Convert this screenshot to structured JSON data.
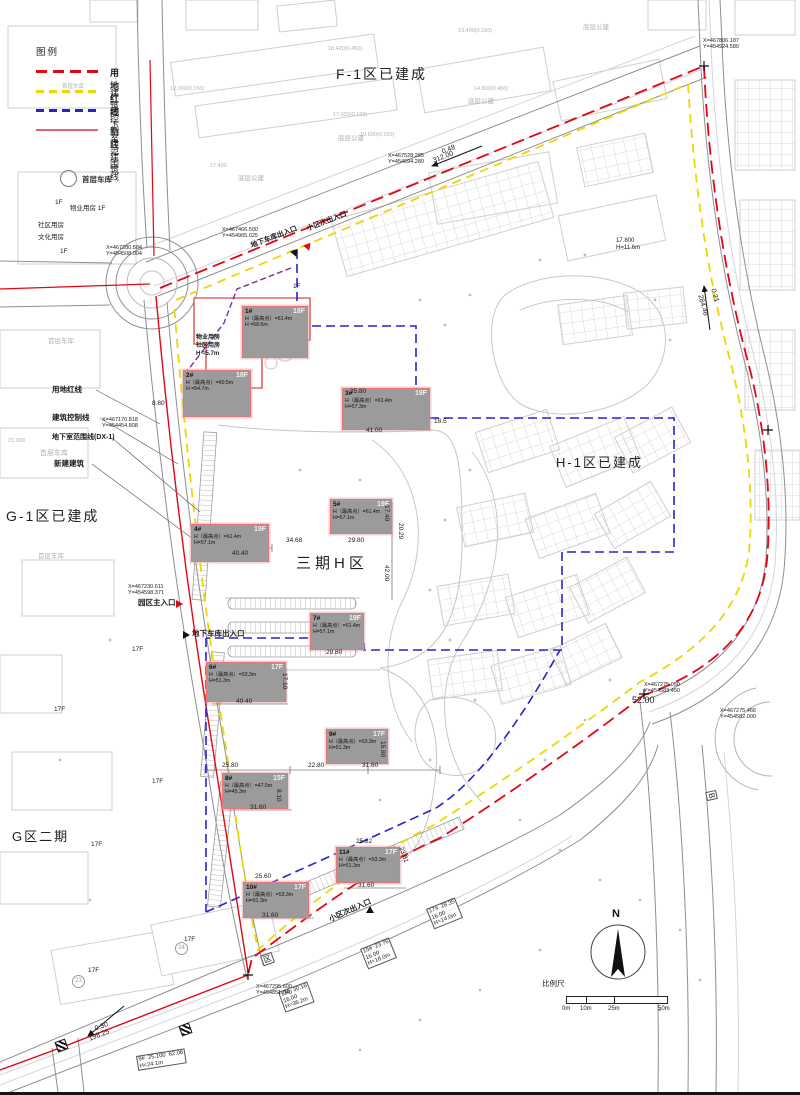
{
  "colors": {
    "red_line": "#e30613",
    "yellow_line": "#ecd800",
    "blue_line": "#2424c8",
    "purple_line": "#7a2f9e",
    "building_fill": "#9b9b9b",
    "building_outline": "#e07a7a",
    "linework": "#cfcfcf",
    "text": "#1c1c1c"
  },
  "legend": {
    "title": "图例",
    "garage_label": "首层车库",
    "garage_faint": "首层车库",
    "items": [
      {
        "label": "用地红线"
      },
      {
        "label": "建筑控制线"
      },
      {
        "label": "地下室范围线"
      },
      {
        "label": "新建建筑"
      }
    ]
  },
  "areas": {
    "f1": "F-1区已建成",
    "h1": "H-1区已建成",
    "g1": "G-1区已建成",
    "g2": "G区二期",
    "h3": "三期H区"
  },
  "buildings": [
    {
      "id": "1#",
      "floors": "18F",
      "hmax": "H（最高点）=61.4m",
      "h": "H =58.6m"
    },
    {
      "id": "2#",
      "floors": "18F",
      "hmax": "H（最高点）=60.5m",
      "h": "H =54.7m"
    },
    {
      "id": "3#",
      "floors": "19F",
      "hmax": "H（最高点）=61.4m",
      "h": "H=57.3m"
    },
    {
      "id": "4#",
      "floors": "19F",
      "hmax": "H（最高点）=61.4m",
      "h": "H=57.1m"
    },
    {
      "id": "5#",
      "floors": "19F",
      "hmax": "H（最高点）=61.4m",
      "h": "H=57.1m"
    },
    {
      "id": "6#",
      "floors": "17F",
      "hmax": "H（最高点）=53.3m",
      "h": "H=51.3m"
    },
    {
      "id": "7#",
      "floors": "19F",
      "hmax": "H（最高点）=61.4m",
      "h": "H=57.1m"
    },
    {
      "id": "8#",
      "floors": "15F",
      "hmax": "H（最高点）=47.5m",
      "h": "H=45.3m"
    },
    {
      "id": "9#",
      "floors": "17F",
      "hmax": "H（最高点）=53.3m",
      "h": "H=51.3m"
    },
    {
      "id": "10#",
      "floors": "17F",
      "hmax": "H（最高点）=53.3m",
      "h": "H=51.3m"
    },
    {
      "id": "11#",
      "floors": "17F",
      "hmax": "H（最高点）=53.3m",
      "h": "H=51.3m"
    }
  ],
  "property_house": {
    "line1": "物业用房",
    "line2": "社区用房",
    "line3": "H =5.7m"
  },
  "callouts": {
    "red": "用地红线",
    "control": "建筑控制线",
    "basement": "地下室范围线(DX-1)",
    "newbld": "新建建筑",
    "garage": "首层车库"
  },
  "entrances": {
    "garage_top": "地下车库出入口",
    "side_top": "小区次出入口",
    "main": "园区主入口",
    "garage_mid": "地下车库出入口",
    "side_bottom": "小区次出入口"
  },
  "compass": {
    "n": "N"
  },
  "scalebar": {
    "title": "比例尺",
    "ticks": [
      "0m",
      "10m",
      "25m",
      "50m"
    ]
  },
  "coords": [
    {
      "lines": [
        "X=467466.500",
        "Y=454965.025"
      ],
      "x": 222,
      "y": 227
    },
    {
      "lines": [
        "X=467806.187",
        "Y=454924.580"
      ],
      "x": 703,
      "y": 38
    },
    {
      "lines": [
        "X=467528.285",
        "Y=454694.280"
      ],
      "x": 388,
      "y": 153
    },
    {
      "lines": [
        "X=467280.584",
        "Y=454508.004"
      ],
      "x": 106,
      "y": 245
    },
    {
      "lines": [
        "X=467230.611",
        "Y=454598.371"
      ],
      "x": 128,
      "y": 584
    },
    {
      "lines": [
        "X=467275.050",
        "Y=454583.450"
      ],
      "x": 644,
      "y": 682
    },
    {
      "lines": [
        "X=467275.466",
        "Y=454582.000"
      ],
      "x": 720,
      "y": 708
    },
    {
      "lines": [
        "X=467295.600",
        "Y=454851.040"
      ],
      "x": 256,
      "y": 984
    },
    {
      "lines": [
        "X=467170.818",
        "Y=454454.808"
      ],
      "x": 102,
      "y": 417
    }
  ],
  "road_labels": [
    {
      "t": "0.48",
      "x": 441,
      "y": 149,
      "r": -21,
      "fs": 7
    },
    {
      "t": "312.00",
      "x": 432,
      "y": 158,
      "r": -21,
      "fs": 7
    },
    {
      "t": "0.21",
      "x": 716,
      "y": 288,
      "r": 74,
      "fs": 7
    },
    {
      "t": "284.48",
      "x": 703,
      "y": 294,
      "r": 74,
      "fs": 7
    },
    {
      "t": "0.30",
      "x": 94,
      "y": 1026,
      "r": -21,
      "fs": 7
    },
    {
      "t": "198.25",
      "x": 88,
      "y": 1036,
      "r": -21,
      "fs": 7
    },
    {
      "t": "52.00",
      "x": 632,
      "y": 695,
      "r": 0,
      "fs": 9
    }
  ],
  "dims": [
    {
      "t": "40.40",
      "x": 232,
      "y": 550
    },
    {
      "t": "40.40",
      "x": 236,
      "y": 698
    },
    {
      "t": "34.68",
      "x": 286,
      "y": 537
    },
    {
      "t": "29.80",
      "x": 348,
      "y": 537
    },
    {
      "t": "29.80",
      "x": 326,
      "y": 649
    },
    {
      "t": "35.80",
      "x": 350,
      "y": 388
    },
    {
      "t": "41.00",
      "x": 366,
      "y": 427
    },
    {
      "t": "18.5",
      "x": 434,
      "y": 418
    },
    {
      "t": "17.40",
      "x": 390,
      "y": 505,
      "r": 90
    },
    {
      "t": "42.00",
      "x": 390,
      "y": 565,
      "r": 90
    },
    {
      "t": "20.29",
      "x": 404,
      "y": 523,
      "r": 90
    },
    {
      "t": "25.80",
      "x": 222,
      "y": 762
    },
    {
      "t": "22.80",
      "x": 308,
      "y": 762
    },
    {
      "t": "31.60",
      "x": 362,
      "y": 762
    },
    {
      "t": "31.60",
      "x": 250,
      "y": 804
    },
    {
      "t": "31.60",
      "x": 358,
      "y": 882
    },
    {
      "t": "31.60",
      "x": 262,
      "y": 912
    },
    {
      "t": "25.60",
      "x": 255,
      "y": 873
    },
    {
      "t": "25.82",
      "x": 356,
      "y": 838
    },
    {
      "t": "23.81",
      "x": 404,
      "y": 846,
      "r": 70
    },
    {
      "t": "15.80",
      "x": 386,
      "y": 741,
      "r": 90
    },
    {
      "t": "17.10",
      "x": 288,
      "y": 673,
      "r": 90
    },
    {
      "t": "8.80",
      "x": 152,
      "y": 400
    },
    {
      "t": "8.10",
      "x": 282,
      "y": 789,
      "r": 90
    }
  ],
  "annotations": [
    {
      "lines": [
        "12#  30.16",
        "16.00",
        "H=36.2m"
      ],
      "x": 278,
      "y": 992,
      "r": -20,
      "box": 1,
      "fs": 5.8
    },
    {
      "lines": [
        "15#  23.76",
        "16.00",
        "H=18.0m"
      ],
      "x": 360,
      "y": 949,
      "r": -22,
      "box": 1,
      "fs": 5.8
    },
    {
      "lines": [
        "17#  28.35",
        "16.00",
        "H=14.0m"
      ],
      "x": 426,
      "y": 909,
      "r": -22,
      "box": 1,
      "fs": 5.8
    },
    {
      "lines": [
        "9#  25.100  62.06",
        "H=24.1m"
      ],
      "x": 136,
      "y": 1056,
      "r": -9,
      "box": 1,
      "fs": 5.8
    },
    {
      "lines": [
        "17.800",
        "H=11.6m"
      ],
      "x": 616,
      "y": 238,
      "r": 0,
      "fs": 6
    }
  ],
  "small_labels": [
    {
      "t": "1F",
      "x": 55,
      "y": 199
    },
    {
      "t": "物业用房  1F",
      "x": 70,
      "y": 205
    },
    {
      "t": "社区用房",
      "x": 38,
      "y": 222
    },
    {
      "t": "文化用房",
      "x": 38,
      "y": 234
    },
    {
      "t": "1F",
      "x": 60,
      "y": 248
    },
    {
      "t": "1F",
      "x": 293,
      "y": 283
    },
    {
      "t": "首层车库",
      "x": 48,
      "y": 338,
      "c": "g"
    },
    {
      "t": "首层车库",
      "x": 38,
      "y": 553,
      "c": "g"
    },
    {
      "t": "底层公建",
      "x": 338,
      "y": 135,
      "c": "g"
    },
    {
      "t": "底层公建",
      "x": 468,
      "y": 98,
      "c": "g"
    },
    {
      "t": "底层公建",
      "x": 583,
      "y": 24,
      "c": "g"
    },
    {
      "t": "底层公建",
      "x": 238,
      "y": 175,
      "c": "g"
    },
    {
      "t": "18.420(0.450)",
      "x": 328,
      "y": 46,
      "c": "g",
      "fs": 5.5
    },
    {
      "t": "13.400(0.150)",
      "x": 458,
      "y": 28,
      "c": "g",
      "fs": 5.5
    },
    {
      "t": "14.800(0.450)",
      "x": 474,
      "y": 86,
      "c": "g",
      "fs": 5.5
    },
    {
      "t": "17.020(0.160)",
      "x": 333,
      "y": 112,
      "c": "g",
      "fs": 5.5
    },
    {
      "t": "19.600(0.150)",
      "x": 360,
      "y": 132,
      "c": "g",
      "fs": 5.5
    },
    {
      "t": "12.000(0.150)",
      "x": 170,
      "y": 86,
      "c": "g",
      "fs": 5.5
    },
    {
      "t": "17.400",
      "x": 210,
      "y": 163,
      "c": "g",
      "fs": 5.5
    },
    {
      "t": "21.900",
      "x": 8,
      "y": 438,
      "c": "g",
      "fs": 5.5
    },
    {
      "t": "17F",
      "x": 132,
      "y": 646
    },
    {
      "t": "17F",
      "x": 54,
      "y": 706
    },
    {
      "t": "17F",
      "x": 152,
      "y": 778
    },
    {
      "t": "17F",
      "x": 91,
      "y": 841
    },
    {
      "t": "17F",
      "x": 184,
      "y": 936
    },
    {
      "t": "17F",
      "x": 88,
      "y": 967
    },
    {
      "t": "区",
      "x": 260,
      "y": 956,
      "r": -20,
      "box": 1,
      "fs": 8
    },
    {
      "t": "B",
      "x": 716,
      "y": 790,
      "r": 78,
      "box": 1,
      "fs": 8
    },
    {
      "t": "23",
      "x": 72,
      "y": 975,
      "circ": 1,
      "fs": 6
    },
    {
      "t": "24",
      "x": 175,
      "y": 942,
      "circ": 1,
      "fs": 6
    }
  ]
}
